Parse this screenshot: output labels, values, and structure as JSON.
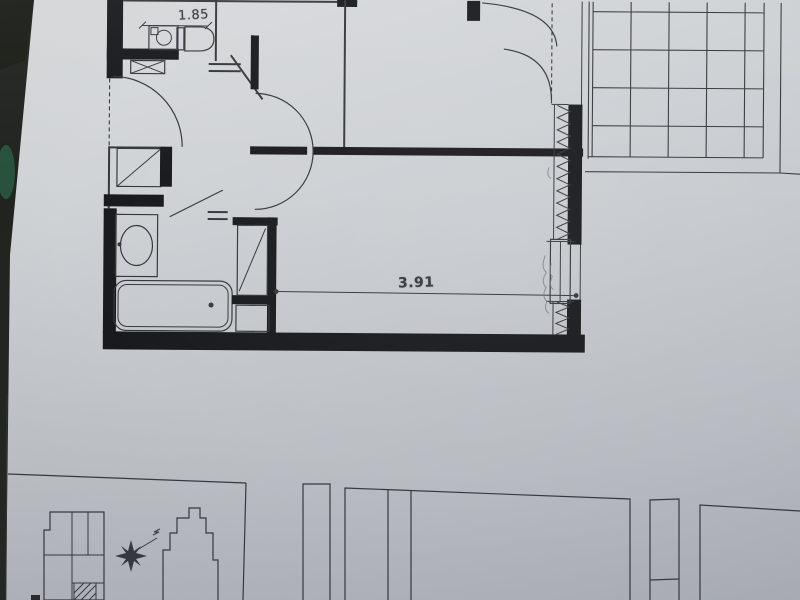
{
  "plan": {
    "dimension_labels": [
      {
        "id": "wc-width",
        "text": "1.85"
      },
      {
        "id": "room-width",
        "text": "3.91"
      }
    ],
    "areas": [
      "wc",
      "hallway",
      "bathroom",
      "wardrobe",
      "main-room",
      "balcony"
    ],
    "fixtures": [
      "washing-machine",
      "toilet",
      "washbasin",
      "bathtub",
      "hall-closet",
      "window",
      "french-doors",
      "entry-door",
      "double-swing-door",
      "tile-grid"
    ]
  },
  "site_plan": {
    "symbols": [
      "north-star",
      "north-arrow",
      "building-outline-left",
      "building-outline-right",
      "unit-location-hatch"
    ]
  },
  "section_drawings": {
    "symbols": [
      "tall-rectangle-strip",
      "wide-panel",
      "narrow-panel",
      "right-panel"
    ]
  },
  "colors": {
    "paper": "#cbcfd3",
    "paper_light": "#dadcdd",
    "paper_shadow": "#b6bac0",
    "ink": "#34373c",
    "wall": "#17191c",
    "pencil": "#7a7d83",
    "backdrop": "#20231e",
    "backdrop_green": "#2a5a41"
  }
}
